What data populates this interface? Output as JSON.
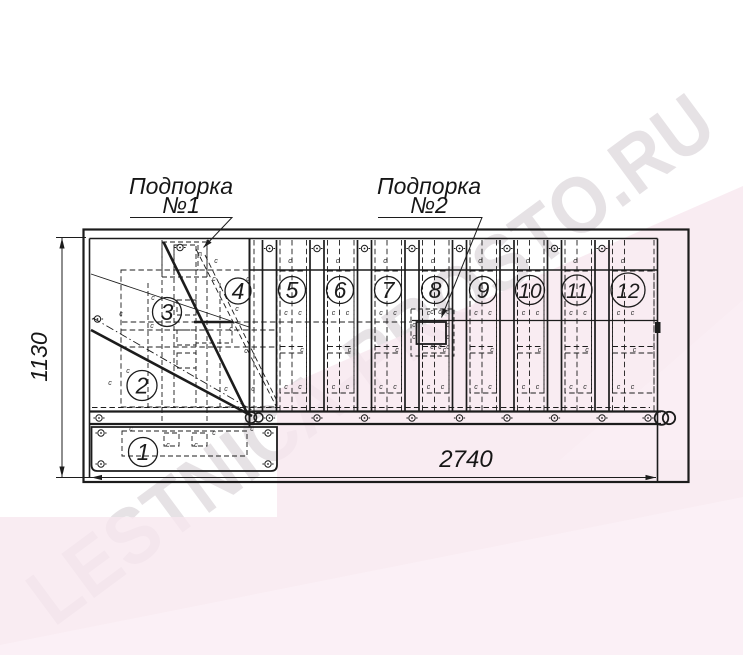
{
  "watermark": "LESTNICA-PROSTO.RU",
  "drawing": {
    "kind": "staircase-top-view-assembly-plan",
    "labels": {
      "support1_line1": "Подпорка",
      "support1_no": "№1",
      "support2_line1": "Подпорка",
      "support2_no": "№2"
    },
    "dimensions": {
      "length": "2740",
      "depth": "1130"
    },
    "step_numbers": [
      "1",
      "2",
      "3",
      "4",
      "5",
      "6",
      "7",
      "8",
      "9",
      "10",
      "11",
      "12"
    ],
    "tick_marks": {
      "default": "c",
      "alt": "п"
    },
    "colors": {
      "line": "#1c1c1c",
      "pink": "#f7e7ef",
      "pink_light": "#fbf1f7",
      "watermark_gray": "#8e7d88"
    }
  }
}
